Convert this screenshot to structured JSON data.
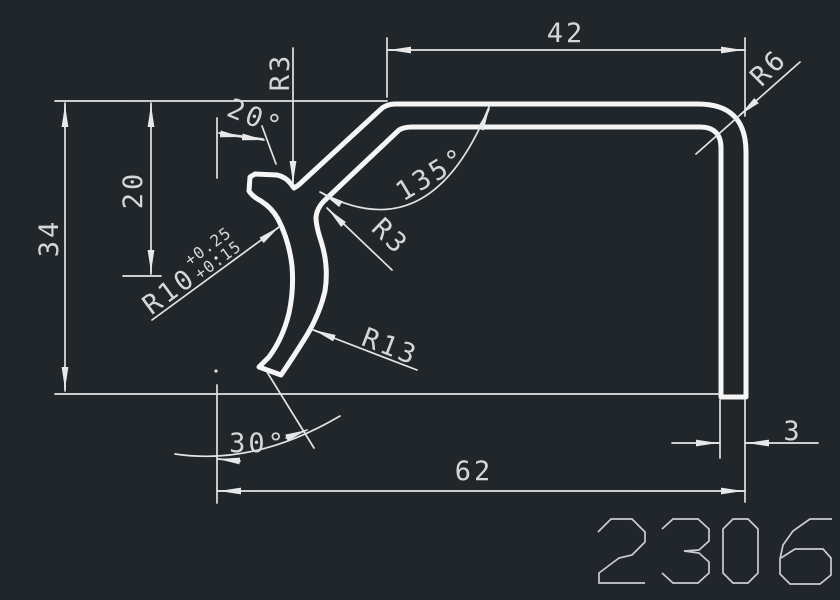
{
  "canvas": {
    "background": "#21262b",
    "profile_line_color": "#f5f5f5",
    "dimension_line_color": "#e3e3e3",
    "text_color": "#d6d6d6"
  },
  "drawing_number": "2306",
  "dimensions": {
    "top_width": "42",
    "corner_radius": "R6",
    "notch_radius": "R3",
    "arm_angle": "20°",
    "upper_height": "20",
    "total_height": "34",
    "bend_angle": "135°",
    "bend_fillet_radius": "R3",
    "hook_outer_radius": "R10",
    "hook_tol_upper": "+0.25",
    "hook_tol_lower": "+0.15",
    "hook_inner_radius": "R13",
    "tip_angle": "30°",
    "total_width": "62",
    "wall_thickness": "3"
  }
}
